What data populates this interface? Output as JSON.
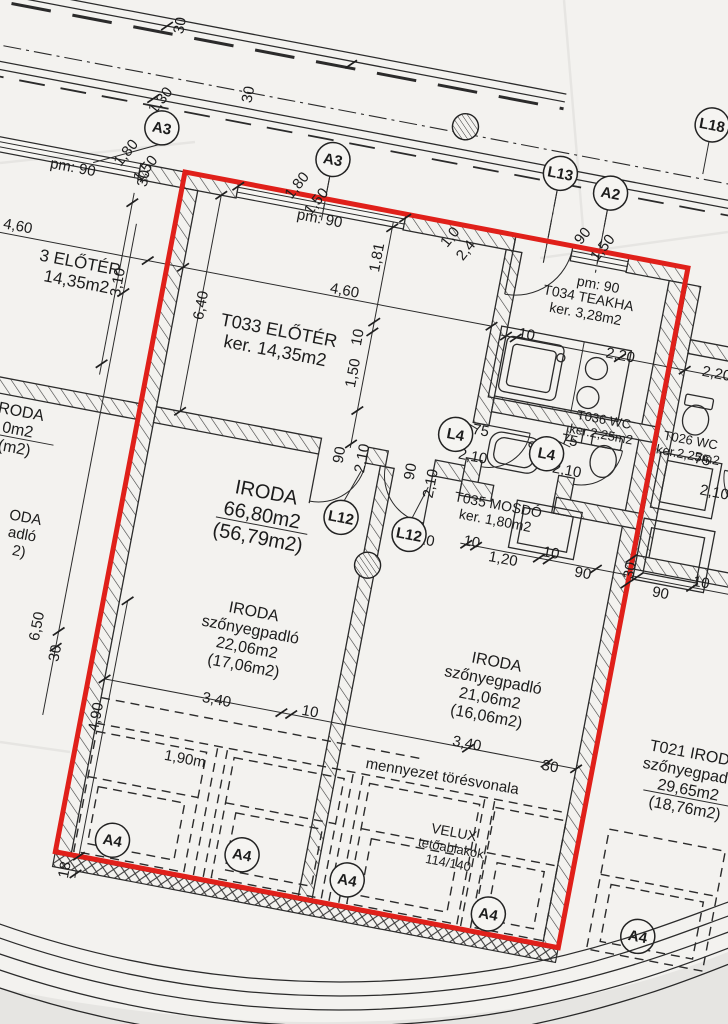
{
  "colors": {
    "highlight_red": "#e0201a",
    "ink": "#2b2b2b",
    "paper": "#f3f2ef"
  },
  "rooms": [
    {
      "id": "t033",
      "lines": [
        "T033 ELŐTÉR",
        "ker. 14,35m2"
      ],
      "x": 122,
      "y": 148,
      "fs": 18
    },
    {
      "id": "iroda-main",
      "lines": [
        "IRODA",
        "66,80m2",
        "(56,79m2)"
      ],
      "x": 140,
      "y": 322,
      "fs": 20
    },
    {
      "id": "iroda-22",
      "lines": [
        "IRODA",
        "szőnyegpadló",
        "22,06m2",
        "(17,06m2)"
      ],
      "x": 150,
      "y": 446,
      "fs": 16
    },
    {
      "id": "iroda-21",
      "lines": [
        "IRODA",
        "szőnyegpadló",
        "21,06m2",
        "(16,06m2)"
      ],
      "x": 398,
      "y": 450,
      "fs": 16
    },
    {
      "id": "t034",
      "lines": [
        "T034 TEAKHA",
        "ker. 3,28m2"
      ],
      "x": 420,
      "y": 56,
      "fs": 14
    },
    {
      "id": "t035",
      "lines": [
        "T035 MOSDÓ",
        "ker. 1,80m2"
      ],
      "x": 370,
      "y": 276,
      "fs": 14
    },
    {
      "id": "t036",
      "lines": [
        "T036 WC",
        "ker.2,25m2"
      ],
      "x": 458,
      "y": 172,
      "fs": 13
    },
    {
      "id": "t026",
      "lines": [
        "T026 WC",
        "ker.2,25m2"
      ],
      "x": 547,
      "y": 176,
      "fs": 13
    },
    {
      "id": "t021",
      "lines": [
        "T021 IRODA",
        "szőnyegpadló",
        "29,65m2",
        "(18,76m2)"
      ],
      "x": 610,
      "y": 503,
      "fs": 16
    },
    {
      "id": "neighbor-eloter",
      "lines": [
        "3 ELŐTÉR",
        "14,35m2"
      ],
      "x": -86,
      "y": 118,
      "fs": 17
    },
    {
      "id": "neighbor-iroda-cut1",
      "lines": [
        "RODA",
        "0m2",
        "(m2)"
      ],
      "x": -116,
      "y": 284,
      "fs": 16
    },
    {
      "id": "neighbor-iroda-cut2",
      "lines": [
        "ODA",
        "adló",
        "2)"
      ],
      "x": -92,
      "y": 386,
      "fs": 15
    }
  ],
  "annotations": [
    {
      "id": "pm90-1",
      "text": "pm: 90",
      "x": -111,
      "y": 16,
      "fs": 15,
      "r": 0
    },
    {
      "id": "pm90-2",
      "text": "pm: 90",
      "x": 141,
      "y": 20,
      "fs": 15,
      "r": 0
    },
    {
      "id": "pm90-3",
      "text": "pm: 90",
      "x": 427,
      "y": 33,
      "fs": 14,
      "r": 0
    },
    {
      "id": "ceiling-break",
      "text": "mennyezet törésvonala",
      "x": 366,
      "y": 545,
      "fs": 15,
      "r": -1
    },
    {
      "id": "velux-1",
      "text": "VELUX",
      "x": 388,
      "y": 598,
      "fs": 14,
      "r": 0
    },
    {
      "id": "velux-2",
      "text": "tetőablakok",
      "x": 388,
      "y": 614,
      "fs": 13,
      "r": 0
    },
    {
      "id": "velux-3",
      "text": "114/140",
      "x": 388,
      "y": 629,
      "fs": 13,
      "r": 0
    },
    {
      "id": "len-190",
      "text": "1,90m",
      "x": 110,
      "y": 576,
      "fs": 15,
      "r": 0
    }
  ],
  "dimensions": [
    {
      "text": "30",
      "x": -33,
      "y": -143,
      "r": -90
    },
    {
      "text": "1,30",
      "x": -38,
      "y": -66,
      "r": -62
    },
    {
      "text": "30",
      "x": 47,
      "y": -88,
      "r": -90
    },
    {
      "text": "1,80",
      "x": -62,
      "y": -8,
      "r": -62
    },
    {
      "text": "1,50",
      "x": -40,
      "y": 4,
      "r": -62
    },
    {
      "text": "1,80",
      "x": 112,
      "y": -8,
      "r": -62
    },
    {
      "text": "1,50",
      "x": 134,
      "y": 4,
      "r": -62
    },
    {
      "text": "90",
      "x": 402,
      "y": -12,
      "r": -62
    },
    {
      "text": "1,50",
      "x": 424,
      "y": -4,
      "r": -62
    },
    {
      "text": "1,0",
      "x": 272,
      "y": 14,
      "r": -62
    },
    {
      "text": "2,4",
      "x": 290,
      "y": 24,
      "r": -62
    },
    {
      "text": "30",
      "x": -40,
      "y": 14,
      "r": -90
    },
    {
      "text": "4,60",
      "x": -154,
      "y": 84,
      "r": 0
    },
    {
      "text": "4,60",
      "x": 179,
      "y": 86,
      "r": 0
    },
    {
      "text": "3,10",
      "x": -46,
      "y": 121,
      "r": -90
    },
    {
      "text": "6,40",
      "x": 40,
      "y": 128,
      "r": -90
    },
    {
      "text": "1,81",
      "x": 204,
      "y": 48,
      "r": -90
    },
    {
      "text": "10",
      "x": 200,
      "y": 130,
      "r": -90
    },
    {
      "text": "1,50",
      "x": 202,
      "y": 166,
      "r": -90
    },
    {
      "text": "10",
      "x": 366,
      "y": 95,
      "r": 0
    },
    {
      "text": "2,20",
      "x": 462,
      "y": 98,
      "r": 0
    },
    {
      "text": "2,20",
      "x": 560,
      "y": 98,
      "r": 0
    },
    {
      "text": "90",
      "x": 204,
      "y": 249,
      "r": -90
    },
    {
      "text": "2,10",
      "x": 227,
      "y": 248,
      "r": -90
    },
    {
      "text": "90",
      "x": 277,
      "y": 252,
      "r": -90
    },
    {
      "text": "2,10",
      "x": 299,
      "y": 260,
      "r": -90
    },
    {
      "text": "10",
      "x": 306,
      "y": 316,
      "r": 0
    },
    {
      "text": "75",
      "x": 339,
      "y": 198,
      "r": 0
    },
    {
      "text": "2,10",
      "x": 336,
      "y": 225,
      "r": 0
    },
    {
      "text": "75",
      "x": 428,
      "y": 191,
      "r": 0
    },
    {
      "text": "2,10",
      "x": 431,
      "y": 221,
      "r": 0
    },
    {
      "text": "75",
      "x": 562,
      "y": 185,
      "r": 0
    },
    {
      "text": "2,10",
      "x": 580,
      "y": 215,
      "r": 0
    },
    {
      "text": "10",
      "x": 351,
      "y": 309,
      "r": 0
    },
    {
      "text": "1,20",
      "x": 385,
      "y": 320,
      "r": 0
    },
    {
      "text": "10",
      "x": 431,
      "y": 305,
      "r": 0
    },
    {
      "text": "90",
      "x": 466,
      "y": 319,
      "r": 0
    },
    {
      "text": "90",
      "x": 546,
      "y": 324,
      "r": 0
    },
    {
      "text": "10",
      "x": 584,
      "y": 306,
      "r": 0
    },
    {
      "text": "30",
      "x": 511,
      "y": 308,
      "r": -90
    },
    {
      "text": "6,50",
      "x": -61,
      "y": 474,
      "r": -90
    },
    {
      "text": "30",
      "x": -38,
      "y": 497,
      "r": -90
    },
    {
      "text": "4,90",
      "x": 14,
      "y": 552,
      "r": -90
    },
    {
      "text": "3,40",
      "x": 130,
      "y": 512,
      "r": 0
    },
    {
      "text": "10",
      "x": 224,
      "y": 506,
      "r": 0
    },
    {
      "text": "3,40",
      "x": 384,
      "y": 508,
      "r": 0
    },
    {
      "text": "30",
      "x": 470,
      "y": 515,
      "r": 0
    },
    {
      "text": "18",
      "x": 12,
      "y": 708,
      "r": -90
    }
  ],
  "grid_markers": [
    {
      "label": "A3",
      "x": -31,
      "y": -39
    },
    {
      "label": "A3",
      "x": 143,
      "y": -40
    },
    {
      "label": "A2",
      "x": 422,
      "y": -59
    },
    {
      "label": "L13",
      "x": 369,
      "y": -69
    },
    {
      "label": "L18",
      "x": 509,
      "y": -145
    },
    {
      "label": "L4",
      "x": 315,
      "y": 207
    },
    {
      "label": "L4",
      "x": 408,
      "y": 209
    },
    {
      "label": "L12",
      "x": 218,
      "y": 310
    },
    {
      "label": "L12",
      "x": 288,
      "y": 314
    },
    {
      "label": "A4",
      "x": 54,
      "y": 670
    },
    {
      "label": "A4",
      "x": 184,
      "y": 660
    },
    {
      "label": "A4",
      "x": 292,
      "y": 665
    },
    {
      "label": "A4",
      "x": 437,
      "y": 672
    },
    {
      "label": "A4",
      "x": 588,
      "y": 666
    }
  ]
}
